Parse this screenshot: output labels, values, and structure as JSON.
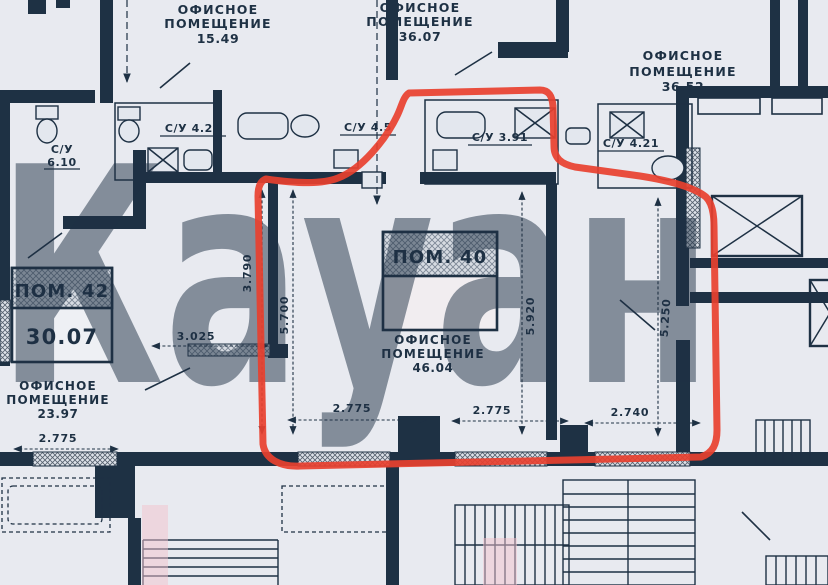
{
  "colors": {
    "paper": "#e8eaf0",
    "ink": "#1e3144",
    "red": "#e8402f",
    "pink": "#f2c3cc"
  },
  "watermark": {
    "text": "Кауан"
  },
  "labels": {
    "office_line1": "ОФИСНОЕ",
    "office_line2": "ПОМЕЩЕНИЕ"
  },
  "areas": {
    "unit_top_left": "15.49",
    "unit_top_mid": "36.07",
    "unit_top_right": "36.52",
    "unit_left": "23.97",
    "unit_center": "46.04"
  },
  "rooms": {
    "pom42_title": "ПОМ. 42",
    "pom42_area": "30.07",
    "pom40_title": "ПОМ. 40"
  },
  "bathrooms": {
    "su_left_label": "С/У",
    "su_left_area": "6.10",
    "su_left2": "С/У 4.21",
    "su_mid": "С/У 4.5",
    "su_center": "С/У 3.91",
    "su_right": "С/У 4.21"
  },
  "dimensions": {
    "v_3790": "3.790",
    "v_5700": "5.700",
    "v_5920": "5.920",
    "v_5250": "5.250",
    "h_3025": "3.025",
    "h_2775_left": "2.775",
    "h_2775_a": "2.775",
    "h_2775_b": "2.775",
    "h_2740": "2.740"
  }
}
